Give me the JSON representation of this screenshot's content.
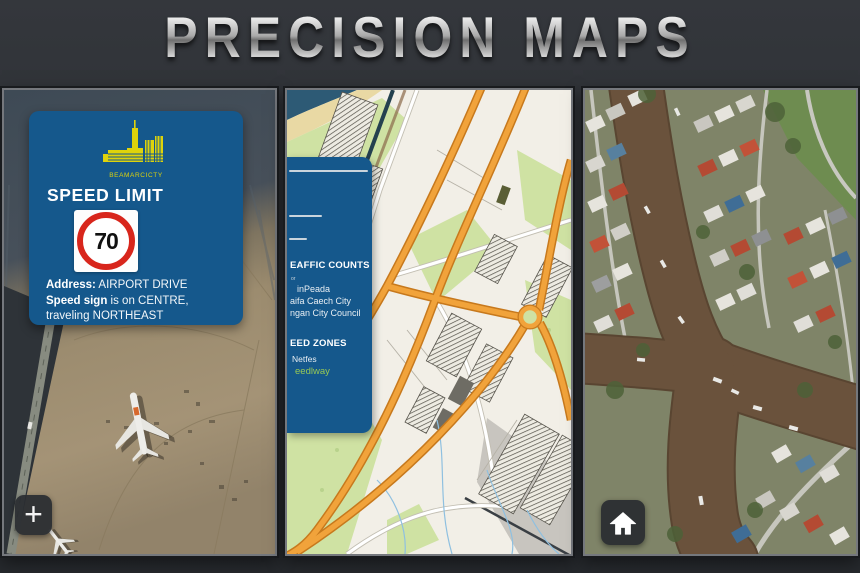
{
  "title": "PRECISION MAPS",
  "airport_panel": {
    "info_card": {
      "logo_caption": "BEAMARCICTY",
      "heading": "SPEED LIMIT",
      "sign_value": "70",
      "address_label": "Address:",
      "address_value": " AIRPORT DRIVE",
      "detail_label": "Speed sign",
      "detail_value": " is on CENTRE, traveling NORTHEAST"
    },
    "zoom_in_label": "+"
  },
  "street_panel": {
    "sidebar": {
      "traffic": {
        "title": "EAFFIC COUNTS",
        "subtext": "or",
        "items": [
          "inPeada",
          "aifa Caech City",
          "ngan City Council"
        ]
      },
      "speed": {
        "title": "EED ZONES",
        "items": [
          "Netfes"
        ],
        "link": "eedlway"
      }
    }
  },
  "colors": {
    "card_blue": "#15588c",
    "highway_orange": "#f1a33b",
    "link_green": "#97c855",
    "logo_yellow": "#ded30b",
    "sign_red": "#d8261c",
    "canal_brown": "#6a523c",
    "title_silver": "#c9c9c9"
  }
}
